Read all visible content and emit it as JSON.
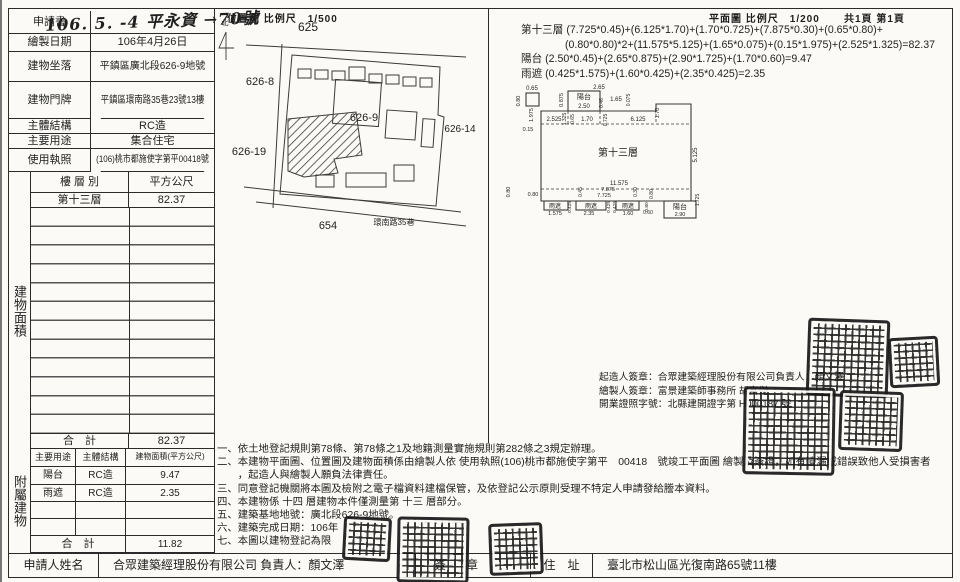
{
  "doc": {
    "application": {
      "label": "申請書",
      "value": "106. 5. -4 平永資 →70號"
    },
    "info_rows": [
      {
        "label": "繪製日期",
        "value": "106年4月26日"
      },
      {
        "label": "建物坐落",
        "value": "平鎮區廣北段626-9地號"
      },
      {
        "label": "建物門牌",
        "value": "平鎮區環南路35巷23號13樓"
      },
      {
        "label": "主體結構",
        "value": "RC造"
      },
      {
        "label": "主要用途",
        "value": "集合住宅"
      },
      {
        "label": "使用執照",
        "value": "(106)桃市都施使字第平00418號"
      }
    ],
    "floor_area": {
      "side": "建物面積",
      "col_floor": "樓 層 別",
      "col_area": "平方公尺",
      "floor": "第十三層",
      "area": "82.37",
      "total_label": "合　計",
      "total": "82.37"
    },
    "annex": {
      "side": "附屬建物",
      "h_use": "主要用途",
      "h_struct": "主體結構",
      "h_area": "建物面積(平方公尺)",
      "rows": [
        {
          "use": "陽台",
          "struct": "RC造",
          "area": "9.47"
        },
        {
          "use": "雨遮",
          "struct": "RC造",
          "area": "2.35"
        }
      ],
      "total_label": "合　計",
      "total": "11.82"
    },
    "applicant": {
      "label": "申請人姓名",
      "value": "合眾建築經理股份有限公司 負責人：顏文澤",
      "sign": "簽　章",
      "addr_label": "住　址",
      "addr": "臺北市松山區光復南路65號11樓"
    }
  },
  "siteplan": {
    "title": "位置圖 比例尺　1/500",
    "labels": [
      {
        "t": "北",
        "x": 9,
        "y": 10,
        "s": 7
      },
      {
        "t": "625",
        "x": 92,
        "y": 16,
        "s": 12
      },
      {
        "t": "626-8",
        "x": 44,
        "y": 70,
        "s": 11
      },
      {
        "t": "626-9",
        "x": 148,
        "y": 106,
        "s": 11
      },
      {
        "t": "626-14",
        "x": 244,
        "y": 117,
        "s": 10
      },
      {
        "t": "626-19",
        "x": 33,
        "y": 140,
        "s": 11
      },
      {
        "t": "654",
        "x": 112,
        "y": 214,
        "s": 11
      },
      {
        "t": "環南路35巷",
        "x": 178,
        "y": 210,
        "s": 8
      }
    ]
  },
  "floorplan": {
    "title": "平面圖 比例尺　1/200",
    "pages": "共1頁 第1頁",
    "labels": [
      {
        "t": "2.65",
        "x": 93,
        "y": 8,
        "s": 6
      },
      {
        "t": "陽台",
        "x": 78,
        "y": 18,
        "s": 7
      },
      {
        "t": "2.50",
        "x": 78,
        "y": 27,
        "s": 6
      },
      {
        "t": "0.875",
        "x": 57,
        "y": 19,
        "s": 5.5,
        "r": -90
      },
      {
        "t": "0.46",
        "x": 97,
        "y": 22,
        "s": 5,
        "r": -90
      },
      {
        "t": "1.65",
        "x": 110,
        "y": 20,
        "s": 6
      },
      {
        "t": "0.075",
        "x": 124,
        "y": 19,
        "s": 5,
        "r": -90
      },
      {
        "t": "1.70",
        "x": 153,
        "y": 32,
        "s": 5.5,
        "r": -90
      },
      {
        "t": "0.65",
        "x": 26,
        "y": 9,
        "s": 6
      },
      {
        "t": "0.80",
        "x": 14,
        "y": 20,
        "s": 5.5,
        "r": -90
      },
      {
        "t": "1.975",
        "x": 27,
        "y": 34,
        "s": 5.5,
        "r": -90
      },
      {
        "t": "2.525",
        "x": 48,
        "y": 40,
        "s": 6
      },
      {
        "t": "1.325",
        "x": 60,
        "y": 38,
        "s": 5,
        "r": -90
      },
      {
        "t": "0.65",
        "x": 68,
        "y": 38,
        "s": 5,
        "r": -90
      },
      {
        "t": "1.70",
        "x": 81,
        "y": 40,
        "s": 6
      },
      {
        "t": "0.725",
        "x": 101,
        "y": 39,
        "s": 5,
        "r": -90
      },
      {
        "t": "6.125",
        "x": 132,
        "y": 40,
        "s": 6
      },
      {
        "t": "0.15",
        "x": 22,
        "y": 50,
        "s": 5.5
      },
      {
        "t": "第十三層",
        "x": 112,
        "y": 75,
        "s": 10
      },
      {
        "t": "5.125",
        "x": 191,
        "y": 74,
        "s": 6,
        "r": -90
      },
      {
        "t": "11.575",
        "x": 113,
        "y": 104,
        "s": 6
      },
      {
        "t": "7.875",
        "x": 102,
        "y": 110,
        "s": 5.5
      },
      {
        "t": "7.725",
        "x": 98,
        "y": 116,
        "s": 5.5
      },
      {
        "t": "0.45",
        "x": 76,
        "y": 111,
        "s": 5,
        "r": -90
      },
      {
        "t": "0.30",
        "x": 131,
        "y": 111,
        "s": 5,
        "r": -90
      },
      {
        "t": "0.80",
        "x": 147,
        "y": 113,
        "s": 5,
        "r": -90
      },
      {
        "t": "0.80",
        "x": 4,
        "y": 111,
        "s": 5.5,
        "r": -90
      },
      {
        "t": "0.80",
        "x": 27,
        "y": 115,
        "s": 5.5
      },
      {
        "t": "雨遮",
        "x": 49,
        "y": 127,
        "s": 6
      },
      {
        "t": "1.575",
        "x": 49,
        "y": 134,
        "s": 5.5
      },
      {
        "t": "0.425",
        "x": 65,
        "y": 126,
        "s": 4.8,
        "r": -90
      },
      {
        "t": "雨遮",
        "x": 85,
        "y": 127,
        "s": 6
      },
      {
        "t": "2.35",
        "x": 83,
        "y": 134,
        "s": 5.5
      },
      {
        "t": "0.425",
        "x": 104,
        "y": 126,
        "s": 4.8,
        "r": -90
      },
      {
        "t": "0.425",
        "x": 110,
        "y": 126,
        "s": 4.8,
        "r": -90
      },
      {
        "t": "雨遮",
        "x": 122,
        "y": 127,
        "s": 6
      },
      {
        "t": "1.60",
        "x": 122,
        "y": 134,
        "s": 5.5
      },
      {
        "t": "0.80",
        "x": 142,
        "y": 126,
        "s": 4.8,
        "r": -90
      },
      {
        "t": "0.60",
        "x": 142,
        "y": 133,
        "s": 5
      },
      {
        "t": "陽台",
        "x": 174,
        "y": 128,
        "s": 7
      },
      {
        "t": "2.90",
        "x": 174,
        "y": 135,
        "s": 5.5
      },
      {
        "t": "1.725",
        "x": 193,
        "y": 119,
        "s": 5,
        "r": -90
      }
    ]
  },
  "calc": {
    "lines": [
      "第十三層 (7.725*0.45)+(6.125*1.70)+(1.70*0.725)+(7.875*0.30)+(0.65*0.80)+",
      "(0.80*0.80)*2+(11.575*5.125)+(1.65*0.075)+(0.15*1.975)+(2.525*1.325)=82.37",
      "陽台 (2.50*0.45)+(2.65*0.875)+(2.90*1.725)+(1.70*0.60)=9.47",
      "雨遮 (0.425*1.575)+(1.60*0.425)+(2.35*0.425)=2.35"
    ]
  },
  "signatures": {
    "lines": [
      "起造人簽章：合眾建築經理股份有限公司負責人：顏文澤",
      "繪製人簽章：富景建築師事務所 胡富傑",
      "開業證照字號：北縣建開證字第 H000187 號"
    ]
  },
  "notes": {
    "lines": [
      "一、依土地登記規則第78條、第78條之1及地籍測量實施規則第282條之3規定辦理。",
      "二、本建物平面圖、位置圖及建物面積係由繪製人依 使用執照(106)桃市都施使字第平　00418　號竣工平面圖 繪製及簽證，如有遺漏或錯誤致他人受損害者",
      "　　，起造人與繪製人願負法律責任。",
      "三、同意登記機關將本圖及檢附之電子檔資料建檔保管，及依登記公示原則受理不特定人申請發給謄本資料。",
      "四、本建物係 十四 層建物本件僅測量第 十三 層部分。",
      "五、建築基地地號：廣北段626-9地號。",
      "六、建築完成日期：106年",
      "七、本圖以建物登記為限"
    ]
  }
}
